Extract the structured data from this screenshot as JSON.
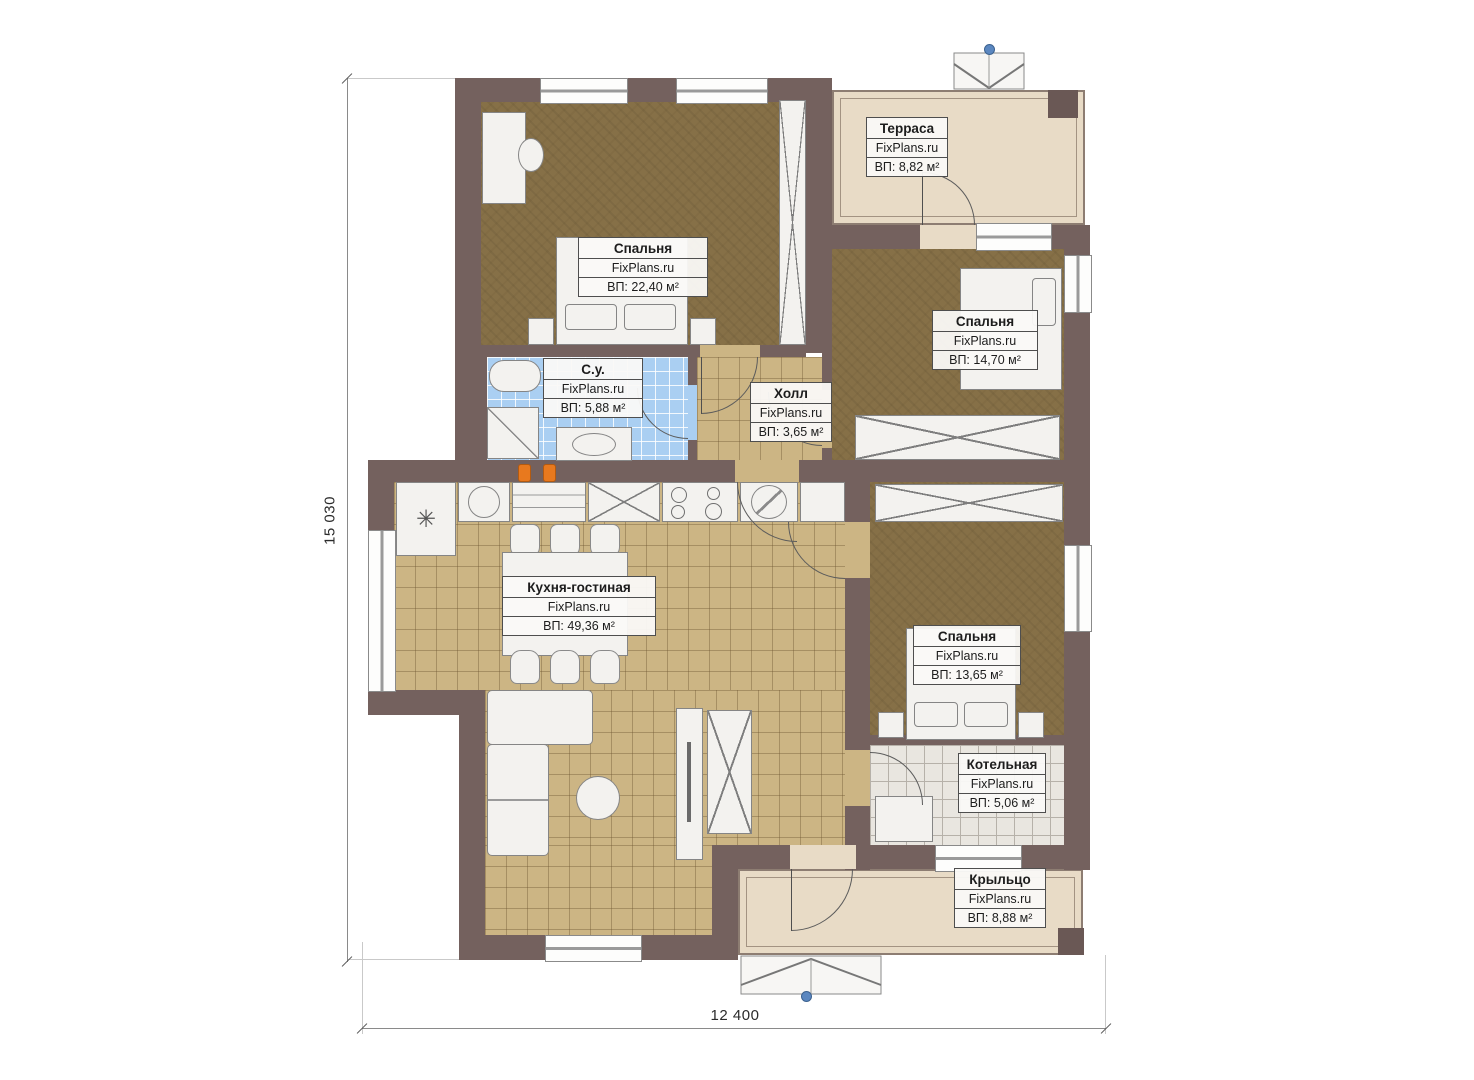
{
  "watermark": "FixPlans.ru",
  "dimensions": {
    "height_label": "15 030",
    "width_label": "12 400"
  },
  "rooms": {
    "terrace": {
      "name": "Терраса",
      "watermark": "FixPlans.ru",
      "area": "ВП: 8,82 м²"
    },
    "bedroom1": {
      "name": "Спальня",
      "watermark": "FixPlans.ru",
      "area": "ВП: 22,40 м²"
    },
    "bedroom2": {
      "name": "Спальня",
      "watermark": "FixPlans.ru",
      "area": "ВП: 14,70 м²"
    },
    "bathroom": {
      "name": "С.у.",
      "watermark": "FixPlans.ru",
      "area": "ВП: 5,88 м²"
    },
    "hall": {
      "name": "Холл",
      "watermark": "FixPlans.ru",
      "area": "ВП: 3,65 м²"
    },
    "kitchen_living": {
      "name": "Кухня-гостиная",
      "watermark": "FixPlans.ru",
      "area": "ВП: 49,36 м²"
    },
    "bedroom3": {
      "name": "Спальня",
      "watermark": "FixPlans.ru",
      "area": "ВП: 13,65 м²"
    },
    "boiler": {
      "name": "Котельная",
      "watermark": "FixPlans.ru",
      "area": "ВП: 5,06 м²"
    },
    "porch": {
      "name": "Крыльцо",
      "watermark": "FixPlans.ru",
      "area": "ВП: 8,88 м²"
    }
  },
  "symbols": {
    "boiler_asterisk": "✳"
  },
  "colors": {
    "wall": "#74615E",
    "bedroom_carpet": "#867047",
    "tile_beige": "#CCB584",
    "tile_blue": "#AACFF2",
    "tile_gray": "#E9E6E0",
    "deck_beige": "#E8DBC6",
    "entry_marker_blue": "#5B87C0",
    "gas_riser_orange": "#E8791E"
  }
}
